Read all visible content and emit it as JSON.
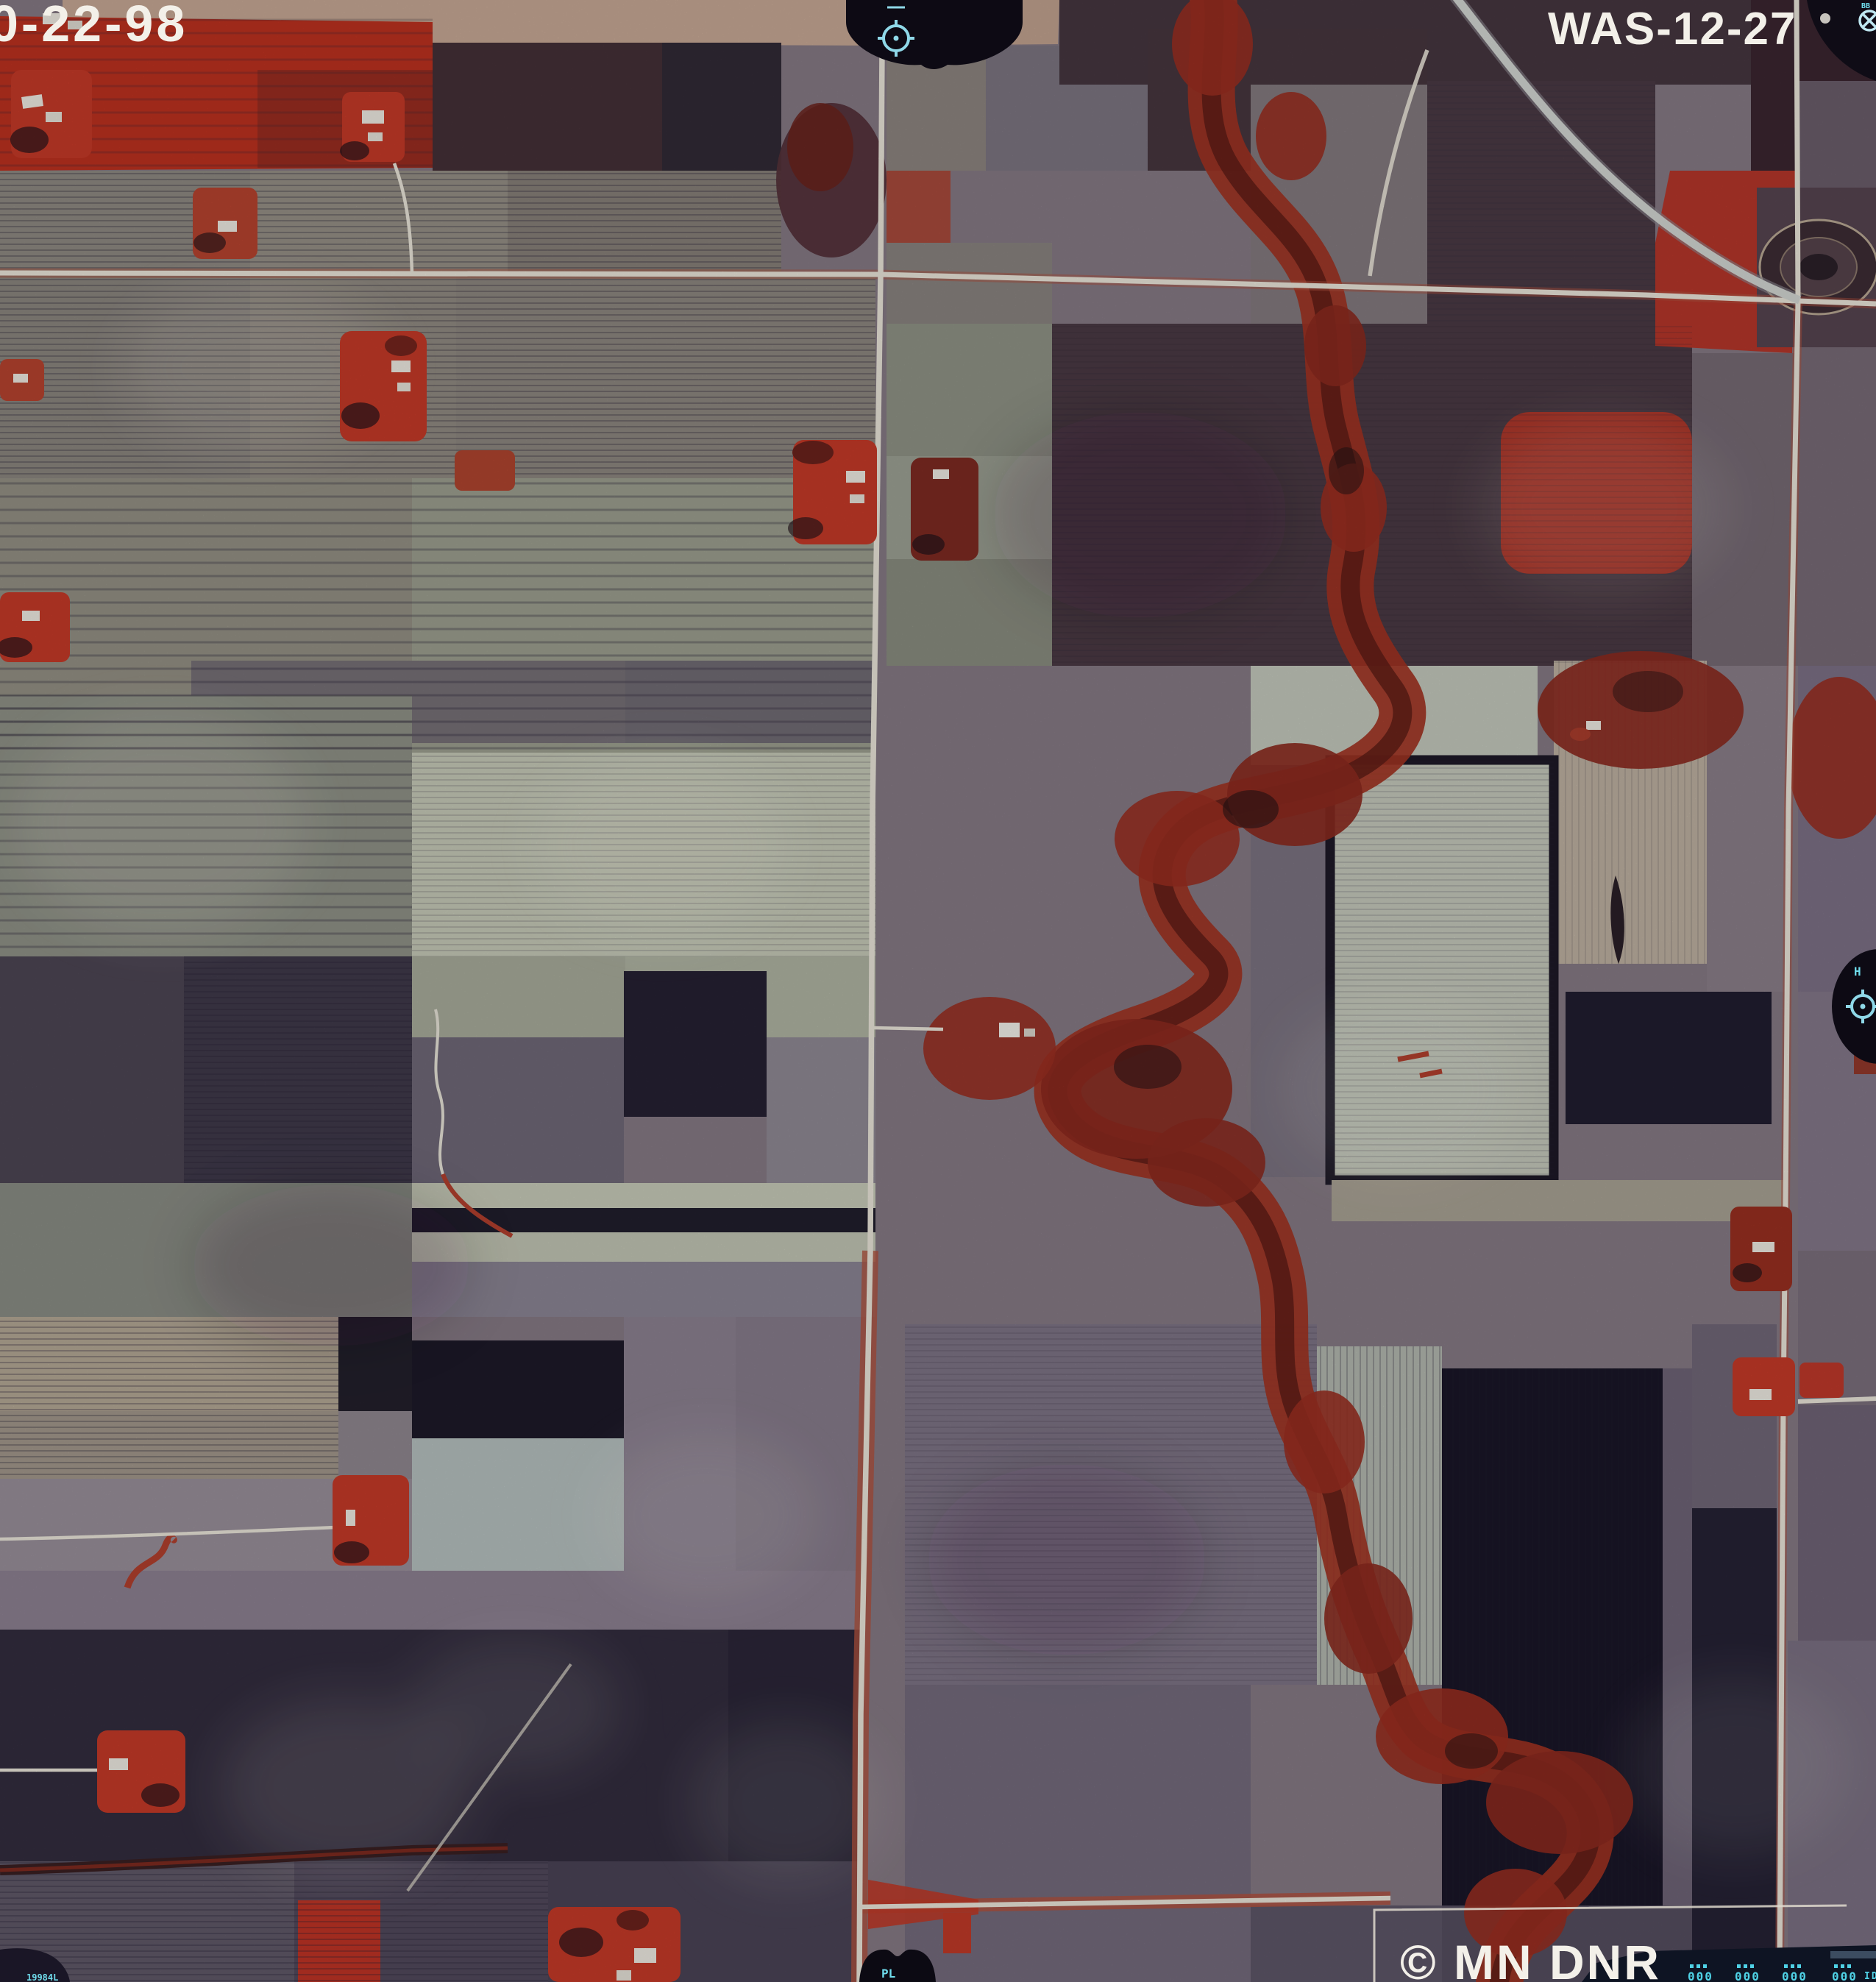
{
  "annotations": {
    "date_label": "0-22-98",
    "photo_id": "WAS-12-27",
    "copyright": "© MN DNR"
  },
  "fiducials": {
    "top_center": {
      "symbol": "crosshair-circle",
      "color": "#8fd8e8"
    },
    "top_right_corner": {
      "symbol": "crosshair-circle",
      "glyph": "BB",
      "color": "#bfe8f2"
    },
    "right_edge": {
      "symbol": "crosshair-circle",
      "glyph": "H",
      "color": "#8fd8e8"
    },
    "bottom_center": {
      "symbol": "black-tab",
      "glyph": "PL",
      "color": "#6fdcec"
    },
    "bottom_left_corner": {
      "symbol": "black-tab",
      "glyph": "19984L",
      "color": "#6fdcec"
    }
  },
  "data_strip": {
    "digit_groups": [
      "000",
      "000",
      "000",
      "000"
    ],
    "end_label": "ID"
  },
  "palette": {
    "label_white": "#f3f0e9",
    "fiducial_cyan": "#8fd8e8",
    "led_cyan": "#4fd2e6",
    "infrared_vegetation_red": "#bd3120",
    "riparian_forest_red": "#9a2f21",
    "bare_field_dark": "#201c2e",
    "field_gray_green": "#939788",
    "field_pale": "#c6cab8",
    "field_tan": "#c7a995",
    "road_white": "#ece8dc",
    "data_strip_navy": "#0e1423"
  },
  "scene": {
    "type": "color-infrared aerial photograph of farmland",
    "features": [
      "rectangular crop fields in gray, tan, pale green and dark tones",
      "bright red infrared signature field at top left",
      "meandering creek with red riparian trees running north to south",
      "straight section-line roads crossing at right angles",
      "curving highway at top right",
      "scattered farmsteads with red windbreak trees and white buildings",
      "ringed oval feature at upper right",
      "camera fiducial marks and data strip at photo edges"
    ]
  }
}
